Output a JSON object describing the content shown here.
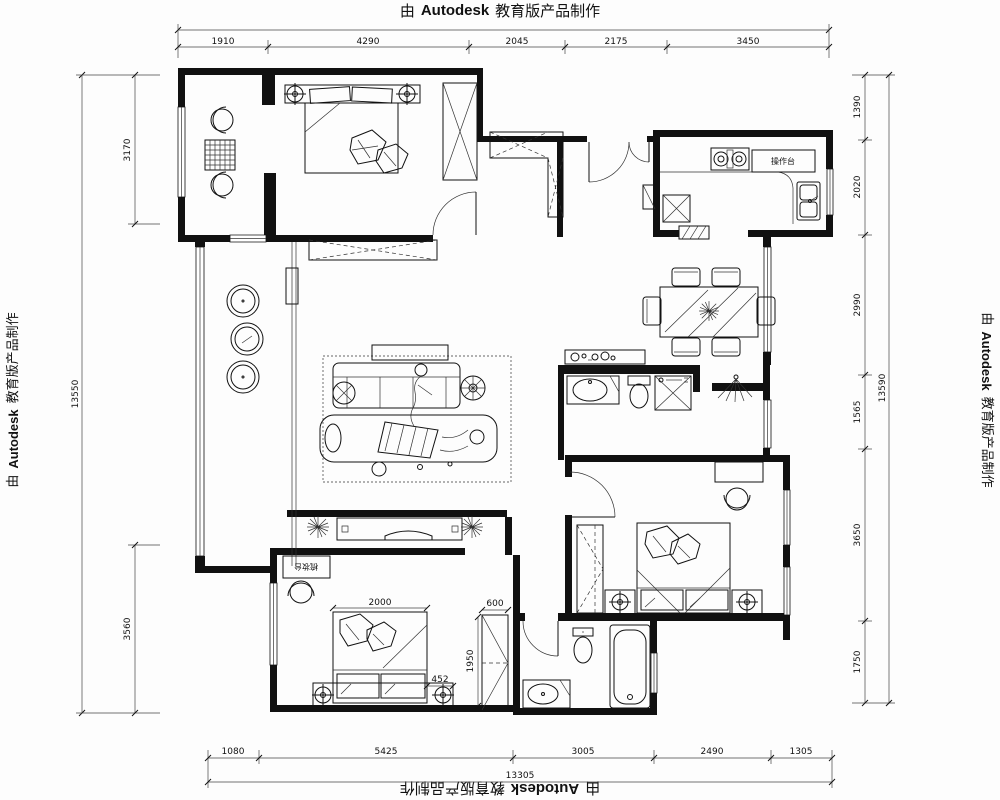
{
  "watermark": {
    "prefix": "由",
    "brand": "Autodesk",
    "suffix": "教育版产品制作"
  },
  "dimensions": {
    "top": [
      "1910",
      "4290",
      "2045",
      "2175",
      "3450"
    ],
    "bottom": [
      "1080",
      "5425",
      "3005",
      "2490",
      "1305"
    ],
    "bottom_total": "13305",
    "left": [
      "3170",
      "3560"
    ],
    "left_total": "13550",
    "right": [
      "1390",
      "2020",
      "2990",
      "1565",
      "3650",
      "1750"
    ],
    "right_total": "13590",
    "bed_width": "2000",
    "nightstand_offset": "452",
    "wardrobe_width": "600",
    "wardrobe_depth": "1950"
  },
  "labels": {
    "kitchen_counter": "操作台",
    "dressing_table": "梳妆台"
  }
}
